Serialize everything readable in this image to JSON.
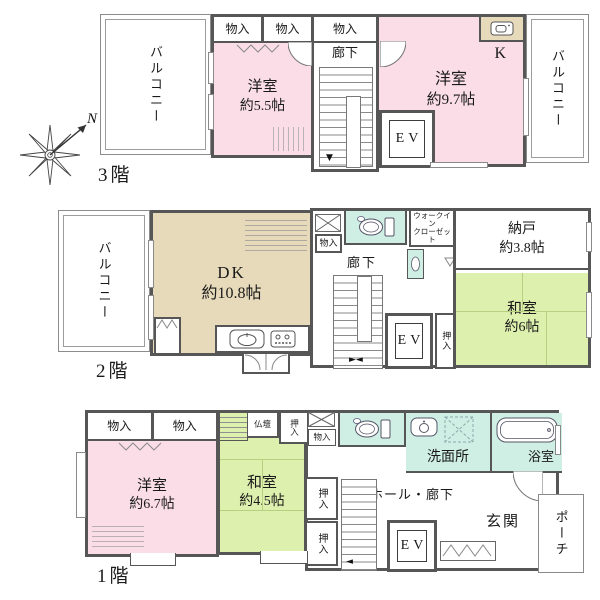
{
  "floors": {
    "f3": {
      "label": "3階",
      "balcony_left": "バルコニー",
      "balcony_right": "バルコニー",
      "storage_a": "物入",
      "storage_b": "物入",
      "storage_c": "物入",
      "hallway": "廊下",
      "room_w55": {
        "name": "洋室",
        "size": "約5.5帖"
      },
      "room_w97": {
        "name": "洋室",
        "size": "約9.7帖"
      },
      "kitchen_label": "K",
      "elevator": "EV"
    },
    "f2": {
      "label": "2階",
      "balcony": "バルコニー",
      "dk": {
        "name": "DK",
        "size": "約10.8帖"
      },
      "storage": "物入",
      "wic_line1": "ウォークイン",
      "wic_line2": "クローゼット",
      "hallway": "廊下",
      "nando": {
        "name": "納戸",
        "size": "約3.8帖"
      },
      "washitsu": {
        "name": "和室",
        "size": "約6帖"
      },
      "elevator": "EV",
      "oshiire": "押入"
    },
    "f1": {
      "label": "1階",
      "storage_a": "物入",
      "storage_b": "物入",
      "storage_c": "物入",
      "room_w67": {
        "name": "洋室",
        "size": "約6.7帖"
      },
      "butsudan": "仏壇",
      "oshiire_top": "押入",
      "washitsu": {
        "name": "和室",
        "size": "約4.5帖"
      },
      "oshiire_a": "押入",
      "oshiire_b": "押入",
      "senmenjo": "洗面所",
      "bathroom": "浴室",
      "hall": "ホール・廊下",
      "elevator": "EV",
      "genkan": "玄関",
      "porch": "ポーチ"
    },
    "compass": {
      "north": "N"
    }
  },
  "colors": {
    "wall": "#565656",
    "western_room": "#fadde6",
    "japanese_room": "#def0ae",
    "dining_kitchen": "#e7dabb",
    "wet_area": "#cfeee4"
  }
}
